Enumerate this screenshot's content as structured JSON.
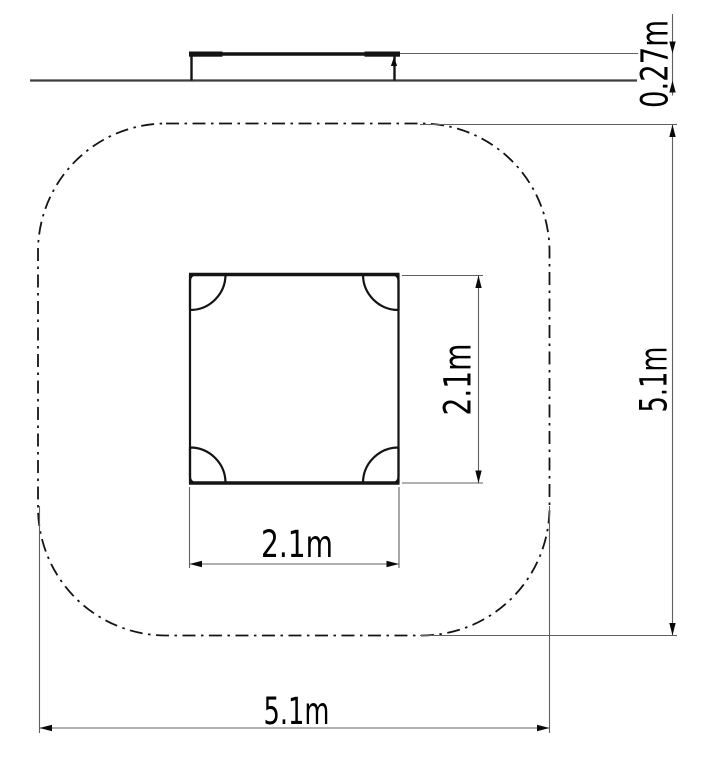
{
  "drawing": {
    "type": "technical-dimension-drawing",
    "background": "#ffffff",
    "colors": {
      "object_line": "#141414",
      "dimension_line": "#606060",
      "text": "#000000"
    },
    "side_view": {
      "height_dimension": {
        "label": "0.27m",
        "orientation": "vertical-rotated"
      }
    },
    "plan_view": {
      "mat_depth_dimension": {
        "label": "2.1m",
        "orientation": "vertical-rotated"
      },
      "mat_width_dimension": {
        "label": "2.1m",
        "orientation": "horizontal"
      },
      "zone_depth_dimension": {
        "label": "5.1m",
        "orientation": "vertical-rotated"
      },
      "zone_width_dimension": {
        "label": "5.1m",
        "orientation": "horizontal"
      }
    }
  }
}
